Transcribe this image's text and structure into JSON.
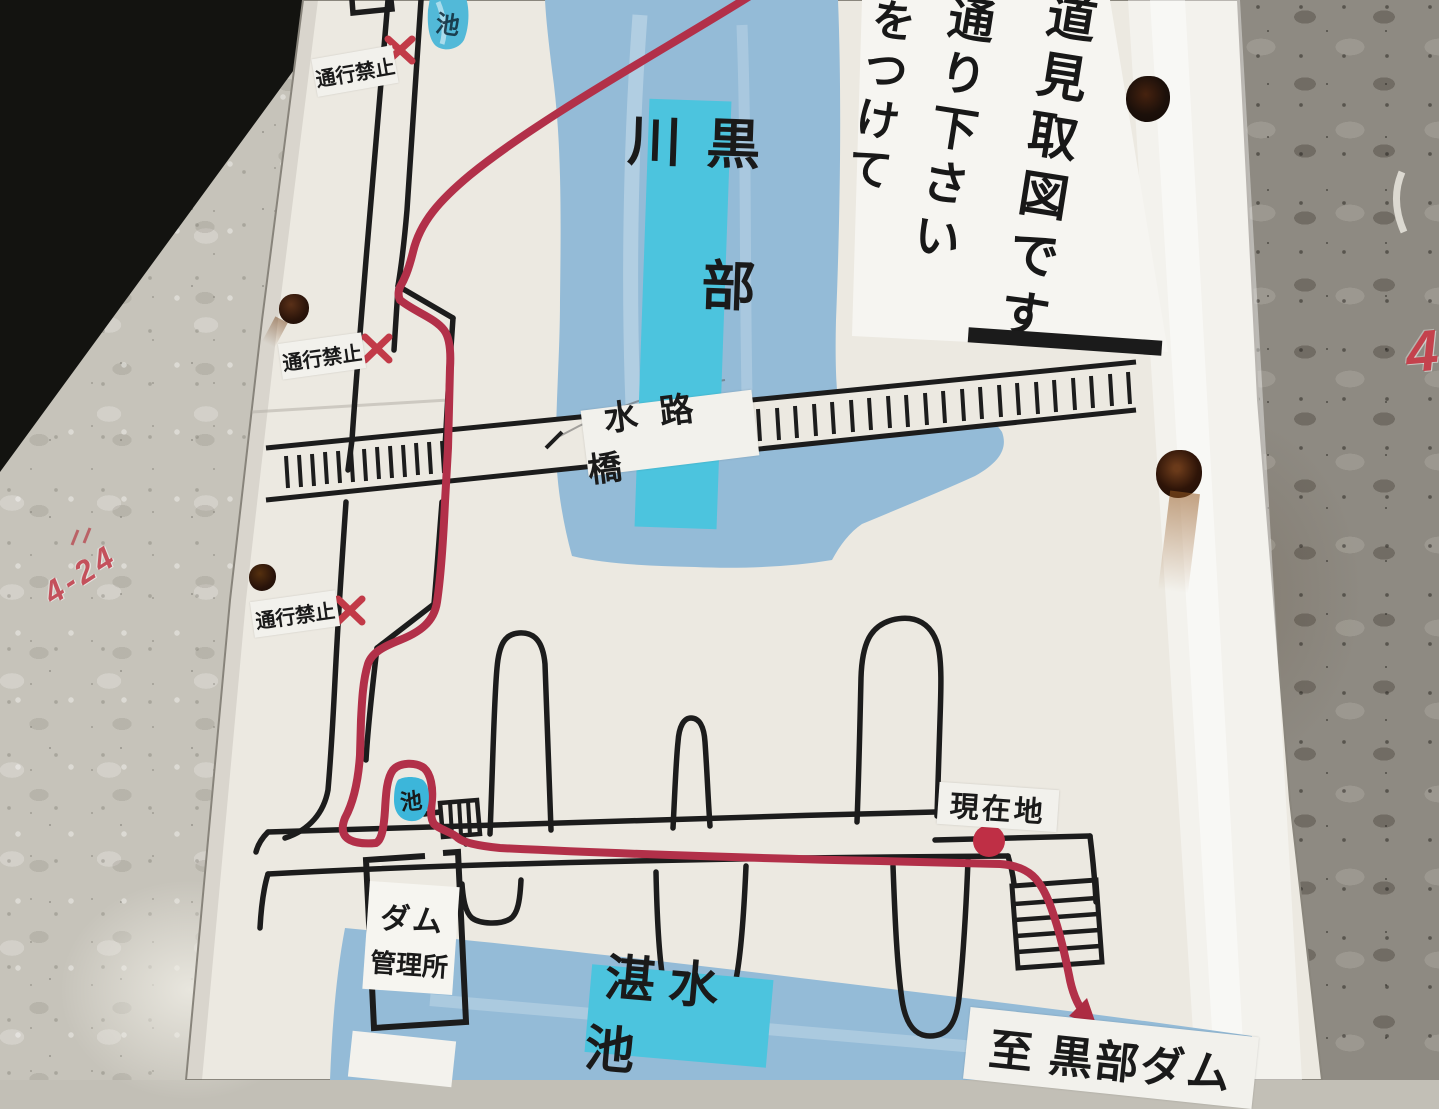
{
  "notice": {
    "line1": "道見取図です",
    "line2": "通り下さい",
    "line3": "をつけて"
  },
  "map_labels": {
    "river": "黒部川",
    "aqueduct_bridge": "水路橋",
    "reservoir": "湛水池",
    "current_location": "現在地",
    "to_destination": "至 黒部ダム",
    "dam_office_line1": "ダム",
    "dam_office_line2": "管理所",
    "no_passage": "通行禁止",
    "pond": "池"
  },
  "graffiti": {
    "wall_left": "4-24",
    "wall_right": "4"
  },
  "colors": {
    "route_red": "#b23049",
    "closed_x_red": "#c23a48",
    "water_blue": "#94bbd7",
    "label_cyan": "#4cc4de",
    "line_black": "#1c1c1c",
    "board_white": "#ece9e1"
  }
}
